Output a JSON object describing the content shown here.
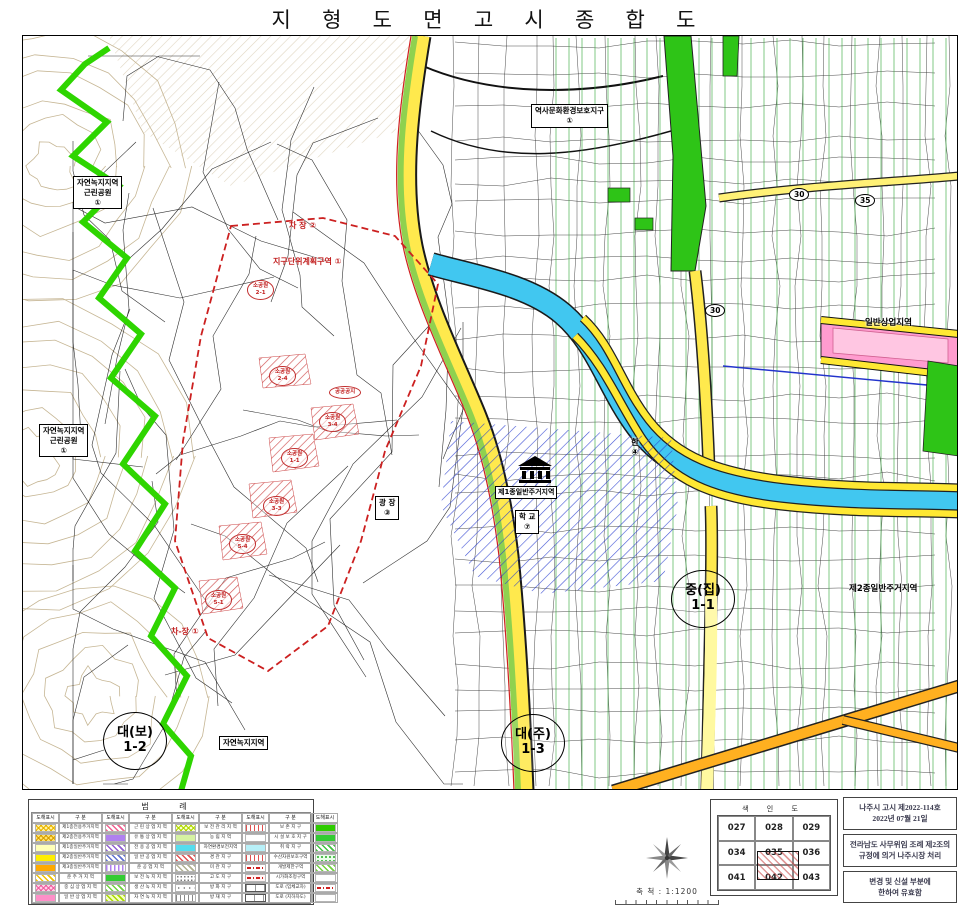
{
  "title": "지 형 도 면 고 시 종 합 도",
  "map": {
    "labels": [
      {
        "id": "zone-park-1",
        "type": "box",
        "lines": [
          "자연녹지지역",
          "근린공원",
          "①"
        ]
      },
      {
        "id": "zone-park-2",
        "type": "box",
        "lines": [
          "자연녹지지역",
          "근린공원",
          "①"
        ]
      },
      {
        "id": "zone-natural-green",
        "type": "box",
        "lines": [
          "자연녹지지역"
        ]
      },
      {
        "id": "heritage-district",
        "type": "box",
        "lines": [
          "역사문화환경보호지구",
          "①"
        ]
      },
      {
        "id": "plaza",
        "type": "box",
        "lines": [
          "광  장",
          "③"
        ]
      },
      {
        "id": "commercial-zone",
        "type": "plain",
        "lines": [
          "일반상업지역"
        ]
      },
      {
        "id": "resid2-zone",
        "type": "plain",
        "lines": [
          "제2종일반주거지역"
        ]
      },
      {
        "id": "school-zone",
        "type": "boxdark",
        "lines": [
          "제1종일반주거지역"
        ]
      },
      {
        "id": "school",
        "type": "box",
        "lines": [
          "학    교",
          "⑦"
        ]
      },
      {
        "id": "river-name",
        "type": "plain",
        "lines": [
          "한",
          "④"
        ]
      },
      {
        "id": "road-width-30a",
        "type": "roadnum",
        "lines": [
          "30"
        ]
      },
      {
        "id": "road-width-35",
        "type": "roadnum",
        "lines": [
          "35"
        ]
      },
      {
        "id": "road-width-30b",
        "type": "roadnum",
        "lines": [
          "30"
        ]
      },
      {
        "id": "parcel-dae-bo",
        "type": "bigcircle",
        "lines": [
          "대(보)",
          "1-2"
        ]
      },
      {
        "id": "parcel-dae-ju",
        "type": "bigcircle",
        "lines": [
          "대(주)",
          "1-3"
        ]
      },
      {
        "id": "parcel-jung-jip",
        "type": "bigcircle",
        "lines": [
          "중(집)",
          "1-1"
        ]
      },
      {
        "id": "district-unit-plan",
        "type": "red",
        "lines": [
          "지구단위계획구역 ①"
        ]
      },
      {
        "id": "parking-1",
        "type": "red",
        "lines": [
          "차-장 ①"
        ]
      },
      {
        "id": "parking-2",
        "type": "red",
        "lines": [
          "차 장 ②"
        ]
      },
      {
        "id": "sp-2-4",
        "type": "redellipse",
        "lines": [
          "소공원",
          "2-4"
        ]
      },
      {
        "id": "sp-3-4",
        "type": "redellipse",
        "lines": [
          "소공원",
          "3-4"
        ]
      },
      {
        "id": "sp-1-1",
        "type": "redellipse",
        "lines": [
          "소공원",
          "1-1"
        ]
      },
      {
        "id": "sp-3-3",
        "type": "redellipse",
        "lines": [
          "소공원",
          "3-3"
        ]
      },
      {
        "id": "sp-5-4",
        "type": "redellipse",
        "lines": [
          "소공원",
          "5-4"
        ]
      },
      {
        "id": "sp-5-1",
        "type": "redellipse",
        "lines": [
          "소공원",
          "5-1"
        ]
      },
      {
        "id": "sp-2-1",
        "type": "redellipse",
        "lines": [
          "소공원",
          "2-1"
        ]
      },
      {
        "id": "open-space",
        "type": "redellipse",
        "lines": [
          "공공공지"
        ]
      }
    ]
  },
  "legend": {
    "title": "범    례",
    "symbol_header": "도해표시",
    "category_header": "구  분",
    "groups": [
      {
        "entries": [
          {
            "swatch": "ycross",
            "label": "제1종전용주거지역"
          },
          {
            "swatch": "ycross2",
            "label": "제2종전용주거지역"
          },
          {
            "swatch": "ypale",
            "label": "제1종일반주거지역"
          },
          {
            "swatch": "ysolid",
            "label": "제2종일반주거지역"
          },
          {
            "swatch": "orange",
            "label": "제3종일반주거지역"
          },
          {
            "swatch": "yhatch",
            "label": "준 주 거 지 역"
          },
          {
            "swatch": "pcross",
            "label": "중 심 상 업 지 역"
          },
          {
            "swatch": "psolid",
            "label": "일 반 상 업 지 역"
          }
        ]
      },
      {
        "entries": [
          {
            "swatch": "phatch",
            "label": "근 린 상 업 지 역"
          },
          {
            "swatch": "vsolid",
            "label": "유 통 상 업 지 역"
          },
          {
            "swatch": "vhatch",
            "label": "전 용 공 업 지 역"
          },
          {
            "swatch": "bhatch",
            "label": "일 반 공 업 지 역"
          },
          {
            "swatch": "vstripe",
            "label": "준 공 업 지 역"
          },
          {
            "swatch": "gsolid",
            "label": "보 전 녹 지 지 역"
          },
          {
            "swatch": "glhatch",
            "label": "생 산 녹 지 지 역"
          },
          {
            "swatch": "yghatch",
            "label": "자 연 녹 지 지 역"
          }
        ]
      },
      {
        "entries": [
          {
            "swatch": "ygcross",
            "label": "보 전 관 리 지 역"
          },
          {
            "swatch": "ltgreen",
            "label": "농 림 지 역"
          },
          {
            "swatch": "cyan",
            "label": "자연환경보전지역"
          },
          {
            "swatch": "rhatch",
            "label": "경 관 지 구"
          },
          {
            "swatch": "lthatch",
            "label": "미 관 지 구"
          },
          {
            "swatch": "dots",
            "label": "고 도 지 구"
          },
          {
            "swatch": "sdots",
            "label": "방 화 지 구"
          },
          {
            "swatch": "vlines",
            "label": "방 재 지 구"
          }
        ]
      },
      {
        "entries": [
          {
            "swatch": "rvlines",
            "label": "보 존 지 구"
          },
          {
            "swatch": "white",
            "label": "시 설 보 호 지 구"
          },
          {
            "swatch": "cyanlt",
            "label": "취 락 지 구"
          },
          {
            "swatch": "rvlines",
            "label": "수산자원보호구역"
          },
          {
            "swatch": "rdash",
            "label": "개발제한구역"
          },
          {
            "swatch": "rdash2",
            "label": "시가화조정구역"
          },
          {
            "swatch": "road",
            "label": "도로 (입체교차)"
          },
          {
            "swatch": "road2",
            "label": "도로 (지하차도)"
          }
        ]
      },
      {
        "entries": [
          {
            "swatch": "gbright"
          },
          {
            "swatch": "gsolid"
          },
          {
            "swatch": "grhatch"
          },
          {
            "swatch": "gdots"
          },
          {
            "swatch": "glhatch"
          },
          {
            "swatch": "white"
          },
          {
            "swatch": "rdash"
          },
          {
            "swatch": "white"
          }
        ]
      }
    ]
  },
  "scale": {
    "label": "축 척 : 1:1200"
  },
  "index_map": {
    "title": "색  인  도",
    "rows": [
      [
        "027",
        "028",
        "029"
      ],
      [
        "034",
        "035",
        "036"
      ],
      [
        "041",
        "042",
        "043"
      ]
    ],
    "highlighted": "042"
  },
  "notices": [
    {
      "lines": [
        "나주시 고시 제2022-114호",
        "2022년 07월 21일"
      ]
    },
    {
      "lines": [
        "전라남도 사무위임 조례 제2조의",
        "규정에 의거 나주시장 처리"
      ]
    },
    {
      "lines": [
        "변경 및 신설 부분에",
        "한하여 유효함"
      ]
    }
  ]
}
